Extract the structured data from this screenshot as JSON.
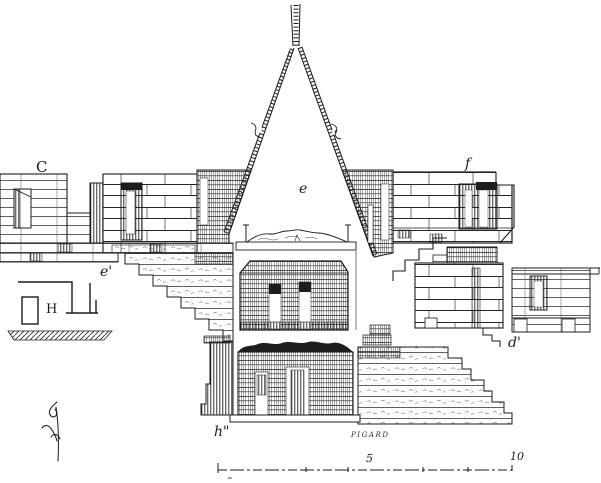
{
  "figure": {
    "paper_color": "#ffffff",
    "ink_color": "#1c1c1c",
    "labels": {
      "c": "C",
      "f": "f",
      "e": "e",
      "e_prime": "e'",
      "h_upper": "H",
      "d_prime": "d'",
      "h_double_prime": "h\"",
      "signature": "PIGARD"
    },
    "scale_bar": {
      "five": "5",
      "ten": "10"
    }
  }
}
